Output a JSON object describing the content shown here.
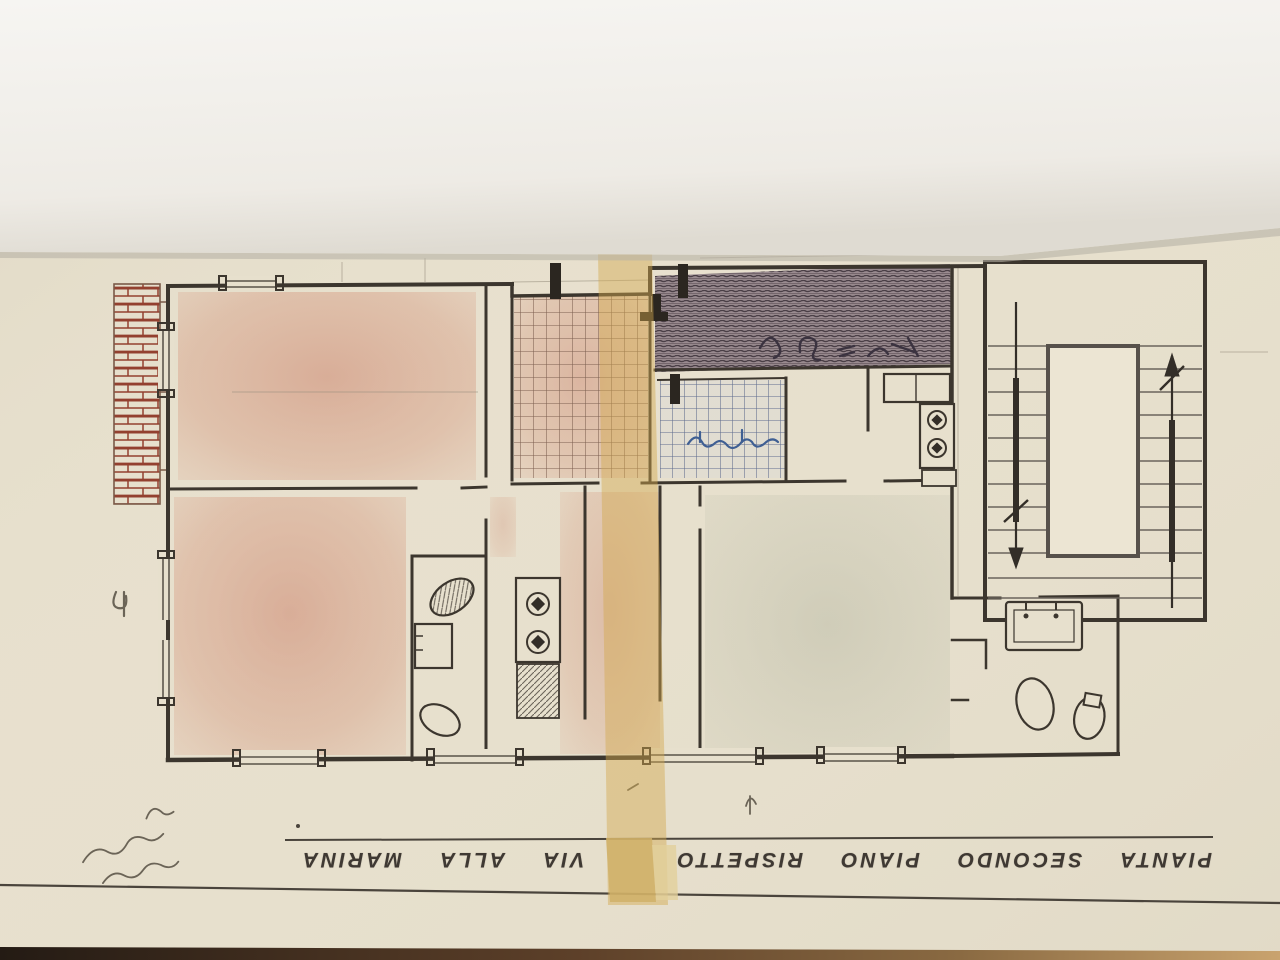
{
  "photo": {
    "scene": "photograph of a hand-drawn architectural floor plan, drawing upside down",
    "top_sheet_color": "#f2f0ea",
    "paper_color": "#e7e0cd",
    "bottom_edge_dark": "#241b14",
    "bottom_edge_tan": "#c9a36e"
  },
  "plan": {
    "title_caption": {
      "text": "PIANTA SECONDO PIANO RISPETTO VIA ALLA MARINA",
      "orientation": "rotated-180",
      "words": [
        "PIANTA",
        "SECONDO",
        "PIANO",
        "RISPETTO",
        "VIA",
        "ALLA",
        "MARINA"
      ]
    },
    "colors": {
      "paper": "#e7e0cd",
      "ink": "#3c362e",
      "red_shade": "#c4674e",
      "green_shade": "#a8ad97",
      "yellow_band": "#d2a84e",
      "yellow_band_bottom": "#d0b068",
      "yellow_band_bottom_light": "#e2cf9b",
      "brick": "#93402f",
      "dark_hatch": "#91828a",
      "tile_line": "#7d5f50",
      "tile_line_blue": "#5f6c8e",
      "blue_ink": "#3f5f93",
      "pencil": "#6b6457"
    },
    "handwriting": {
      "margin_note": "illegible pencil handwriting (rotated 180)",
      "corridor_numbers": "illegible pencil figures inside hatched strip",
      "bathroom_note": "illegible blue ink note inside tiled room",
      "left_edge_mark": "small pencil mark on left margin"
    },
    "features": {
      "stair_flights": 2,
      "stair_arrows": 2,
      "tiled_rooms": 2,
      "brick_hatched_balcony": 1,
      "dark_hatched_balcony": 1
    }
  }
}
